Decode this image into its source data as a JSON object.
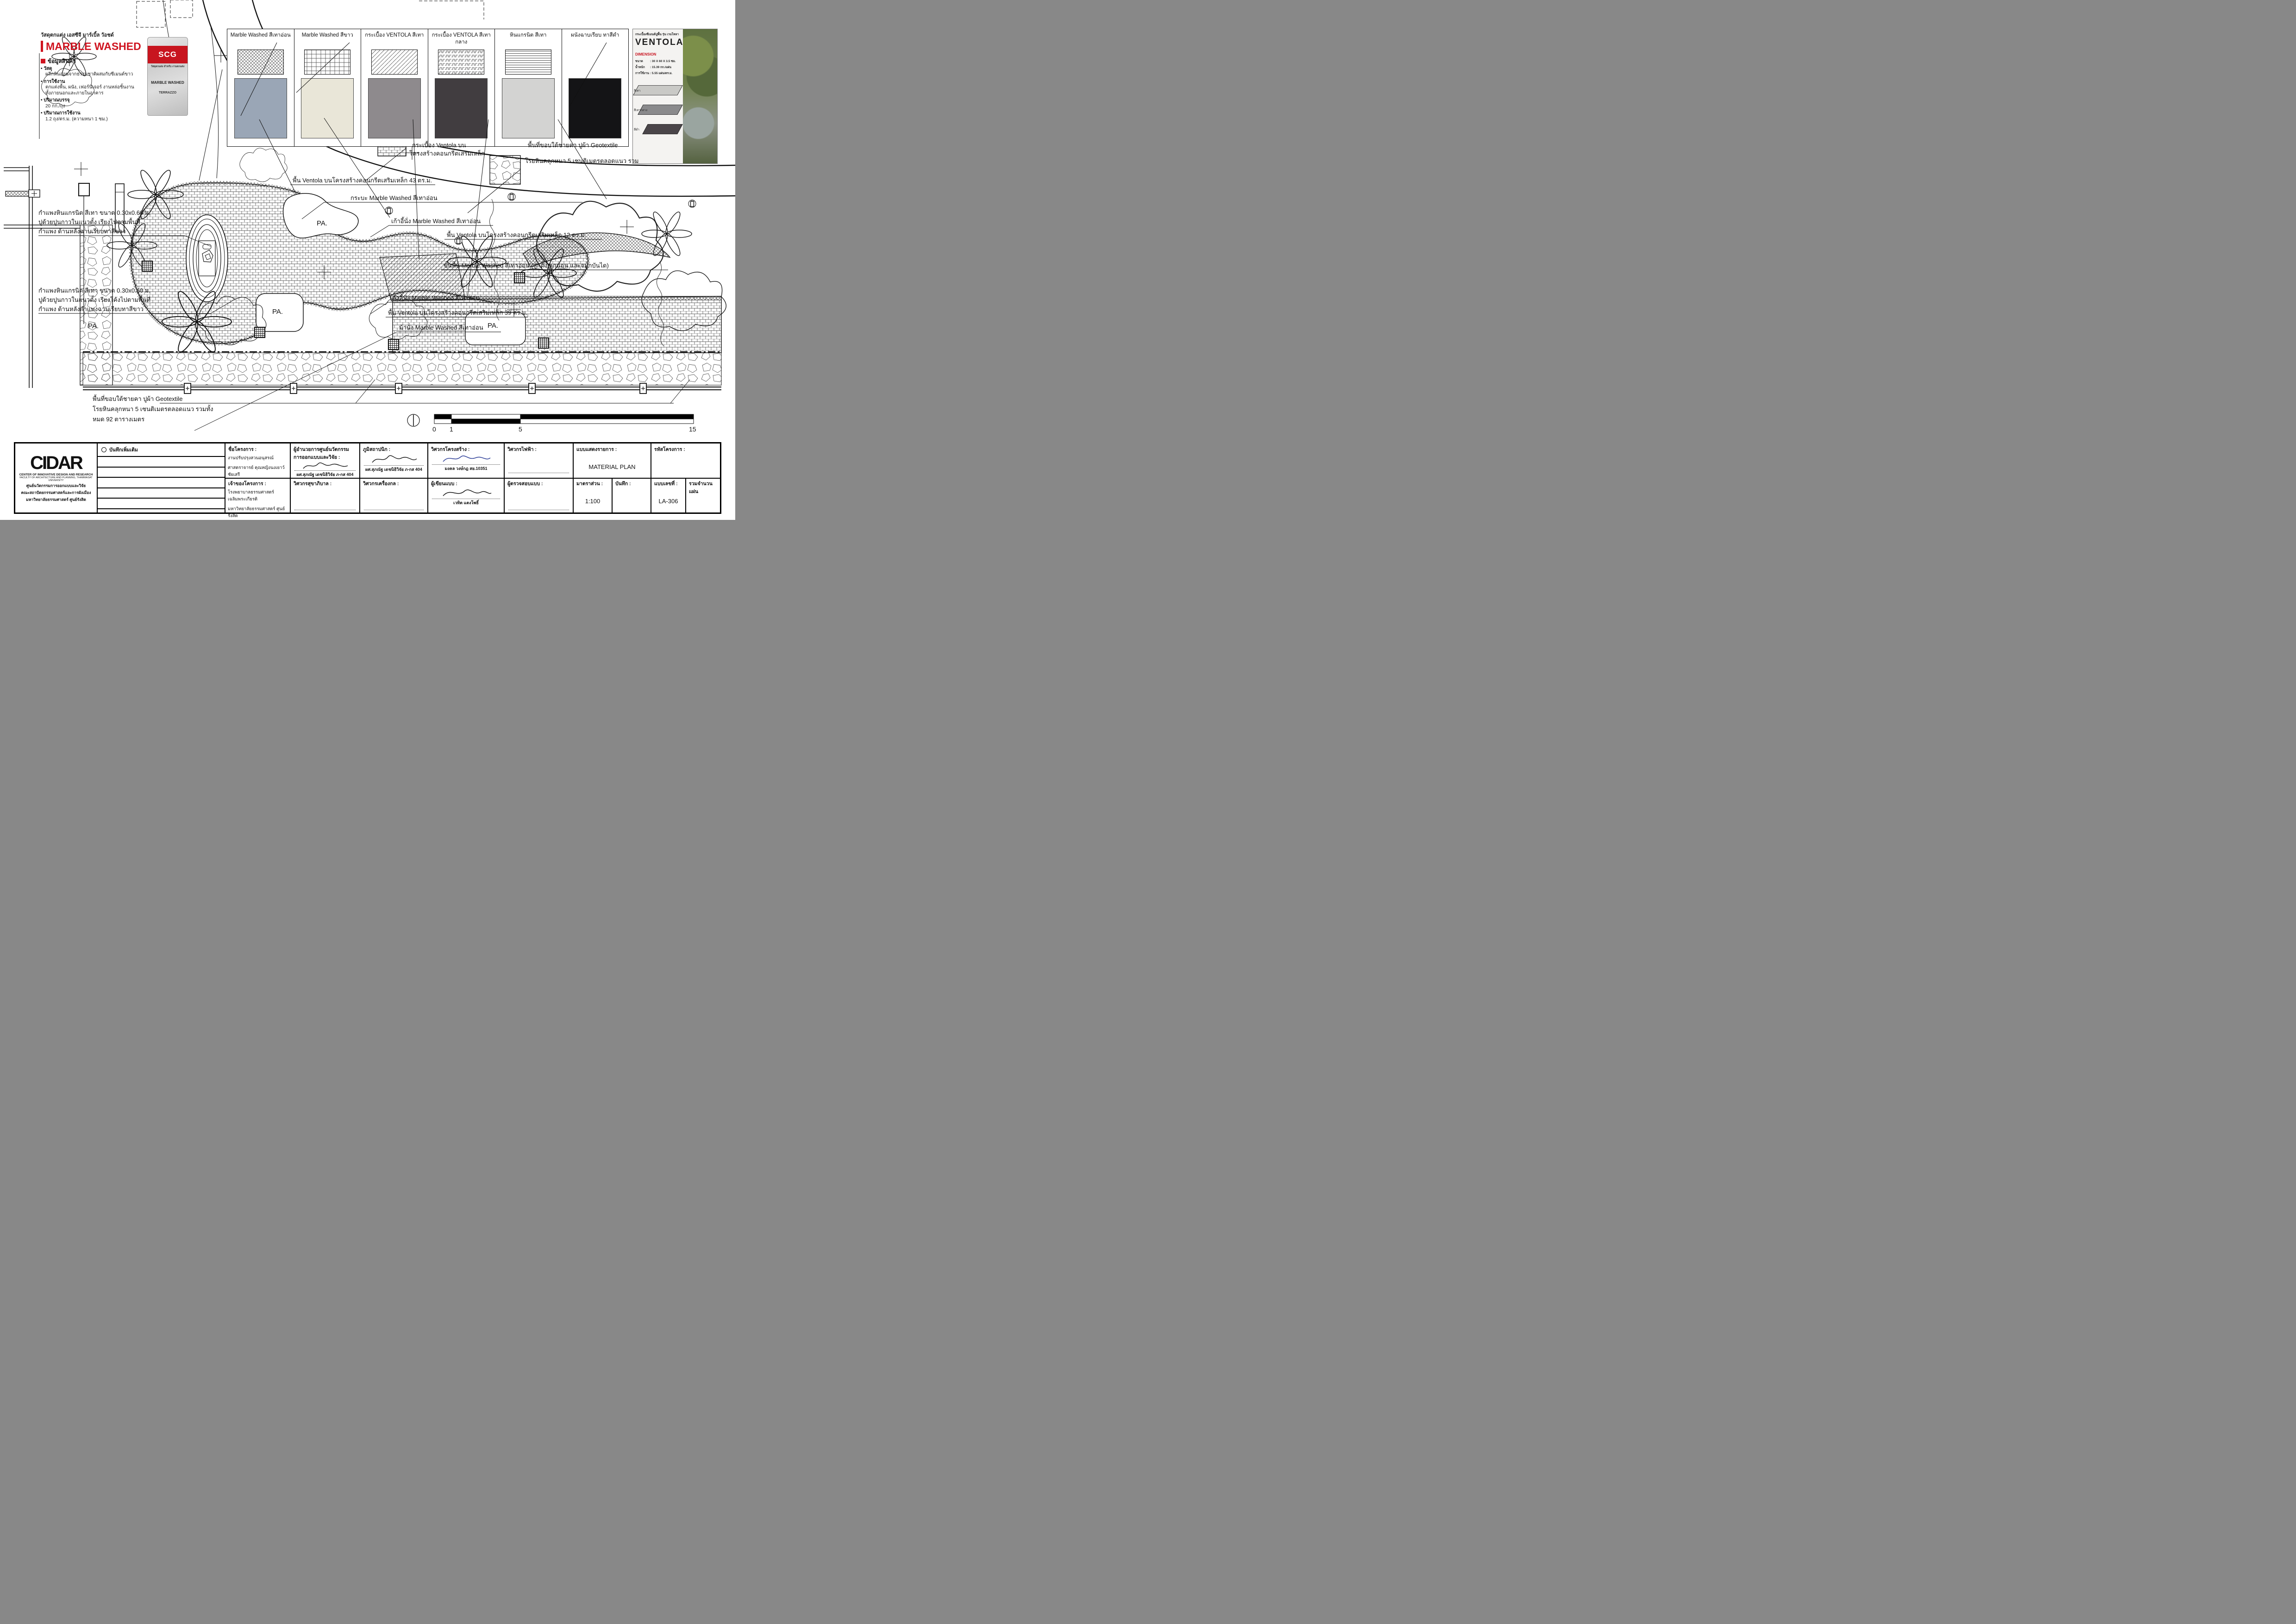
{
  "product_panel": {
    "header": "วัสดุตกแต่ง เอสซีจี มาร์เบิ้ล วัอชด์",
    "brand_title": "MARBLE WASHED",
    "info_header": "ข้อมูลสินค้า",
    "b1_label": "วัสดุ",
    "b1_text": "ผลึกหินอ่อนจากธรรมชาติผสมกับซีเมนต์ขาว",
    "b2_label": "การใช้งาน",
    "b2_text1": "ตกแต่งพื้น, ผนัง, เฟอร์นิเจอร์ งานหล่อชิ้นงาน",
    "b2_text2": "ทั้งภายนอกและภายในอาคาร",
    "b3_label": "ปริมาณบรรจุ",
    "b3_text": "20 กก./ถุง",
    "b4_label": "ปริมาณการใช้งาน",
    "b4_text": "1.2 ถุง/ตร.ม. (ความหนา 1 ซม.)",
    "bag": {
      "brand": "SCG",
      "tagline": "วัสดุตกแต่ง สำหรับ งานตกแต่ง",
      "name": "MARBLE WASHED",
      "series": "TERRAZZO"
    }
  },
  "swatch_panel": {
    "items": [
      {
        "label": "Marble Washed สีเทาอ่อน",
        "hatch": "diamond",
        "photo_color": "#9aa6b6"
      },
      {
        "label": "Marble Washed สีขาว",
        "hatch": "grid",
        "photo_color": "#e9e6d8"
      },
      {
        "label": "กระเบื้อง VENTOLA สีเทา",
        "hatch": "diagonal",
        "photo_color": "#8e8a8d"
      },
      {
        "label": "กระเบื้อง VENTOLA สีเทากลาง",
        "hatch": "zigzag",
        "photo_color": "#413d40"
      },
      {
        "label": "หินแกรนิต สีเทา",
        "hatch": "hlines",
        "photo_color": "#d3d3d2"
      },
      {
        "label": "ผนังฉาบเรียบ ทาสีดำ",
        "hatch": "none",
        "photo_color": "#141416"
      }
    ]
  },
  "ventola_poster": {
    "header": "กระเบื้องซีเมนต์ปูพื้น รุ่น เวนโทลา",
    "title": "VENTOLA",
    "dim_header": "DIMENSION",
    "r1_label": "ขนาด",
    "r1_value": ": 30 X 60 X 3.5 ซม.",
    "r2_label": "น้ำหนัก",
    "r2_value": ": 15.39 กก./แผ่น",
    "r3_label": "การใช้งาน",
    "r3_value": ": 5.55 แผ่น/ตร.ม.",
    "tile1": "สีเทา",
    "tile2": "สีเทากลาง",
    "tile3": "สีดำ"
  },
  "plan": {
    "annotations": [
      {
        "text": "พื้น Ventola บนโครงสร้างคอนกรีตเสริมเหล็ก  43 ตร.ม."
      },
      {
        "text": "กระบะ Marble Washed สีเทาอ่อน"
      },
      {
        "text": "เก้าอี้นั่ง Marble Washed สีเทาอ่อน"
      },
      {
        "text": "พื้น Ventola บนโครงสร้างคอนกรีตเสริมเหล็ก  12 ตร.ม."
      },
      {
        "text": "ขั้นพื้น Marble Washed สีเทาอ่อน (ลูกตั้ง ลูกนอน และจมูกบันได)"
      },
      {
        "text": "เก้าอี้นั่ง Marble Washed สีเทาอ่อน"
      },
      {
        "text": "พื้น Ventola บนโครงสร้างคอนกรีตเสริมเหล็ก  39 ตร.ม."
      },
      {
        "text": "ม้านั่ง Marble Washed สีเทาอ่อน"
      },
      {
        "text": "กำแพงหินแกรนิต สีเทา ขนาด 0.30x0.60 ม."
      },
      {
        "text": "ปูด้วยปูนกาวในแนวตั้ง เรียงไปตามพื้นที่"
      },
      {
        "text": "กำแพง ด้านหลังฉาบเรียบทาสีขาว"
      },
      {
        "text": "กำแพงหินแกรนิต สีเทา ขนาด 0.30x0.60 ม."
      },
      {
        "text": "ปูด้วยปูนกาวในแนวตั้ง เรียงโค้งไปตามพื้นที่"
      },
      {
        "text": "กำแพง ด้านหลังกำแพงฉาบเรียบทาสีขาว"
      },
      {
        "text": "พื้นที่ขอบใต้ชายคา ปูผ้า Geotextile"
      },
      {
        "text": "โรยหินคลุกหนา 5 เซนติเมตรตลอดแนว รวมทั้ง"
      },
      {
        "text": "หมด 92 ตารางเมตร"
      },
      {
        "text": "กระเบื้อง Ventola บน"
      },
      {
        "text": "โครงสร้างคอนกรีตเสริมเหล็ก"
      },
      {
        "text": "พื้นที่ขอบใต้ชายคา ปูผ้า Geotextile"
      },
      {
        "text": "โรยหินคลุกหนา 5 เซนติเมตรตลอดแนว รวม"
      }
    ],
    "pa": [
      "PA.",
      "PA.",
      "PA.",
      "PA."
    ]
  },
  "scale_bar": {
    "n0": "0",
    "n1": "1",
    "n5": "5",
    "n15": "15"
  },
  "title_block": {
    "notes_header": "บันทึกเพิ่มเติม",
    "project_label": "ชื่อโครงการ :",
    "project_1": "งานปรับปรุงสวนอนุสรณ์",
    "project_2": "ศาสตราจารย์ คุณหญิงนงเยาว์ ชัยเสรี",
    "owner_label": "เจ้าของโครงการ :",
    "owner_1": "โรงพยาบาลธรรมศาสตร์เฉลิมพระเกียรติ",
    "owner_2": "มหาวิทยาลัยธรรมศาสตร์ ศูนย์รังสิต",
    "director_label1": "ผู้อำนวยการศูนย์นวัตกรรม",
    "director_label2": "การออกแบบและวิจัย :",
    "director_name": "ผศ.สุภณัฐ เดชนิธิวิจัย ภ-กส 404",
    "sanitary_label": "วิศวกรสุขาภิบาล :",
    "landscape_label": "ภูมิสถาปนิก :",
    "landscape_name": "ผศ.สุภณัฐ เดชนิธิวิจัย ภ-กส 404",
    "mech_label": "วิศวกรเครื่องกล :",
    "struct_label": "วิศวกรโครงสร้าง :",
    "struct_name": "มงคล วงษ์กฎ สย.10351",
    "drafts_label": "ผู้เขียนแบบ :",
    "drafts_name": "เวทิต แตงโพธิ์",
    "elec_label": "วิศวกรไฟฟ้า :",
    "check_label": "ผู้ตรวจสอบแบบ :",
    "doc_label": "แบบแสดงรายการ :",
    "doc_value": "MATERIAL PLAN",
    "scale_label": "มาตราส่วน :",
    "scale_value": "1:100",
    "note_label": "บันทึก :",
    "code_label": "รหัสโครงการ :",
    "sheet_label": "แบบเลขที่ :",
    "sheet_value": "LA-306",
    "total_label": "รวมจำนวนแผ่น",
    "logo": {
      "acronym": "CIDAR",
      "en1": "CENTER OF INNOVATIVE DESIGN AND RESEARCH",
      "en2": "FACULTY OF ARCHITECTURE AND PLANNING, THAMMASAT UNIVERSITY",
      "th1": "ศูนย์นวัตกรรมการออกแบบและวิจัย",
      "th2": "คณะสถาปัตยกรรมศาสตร์และการผังเมือง",
      "th3": "มหาวิทยาลัยธรรมศาสตร์ ศูนย์รังสิต"
    }
  }
}
